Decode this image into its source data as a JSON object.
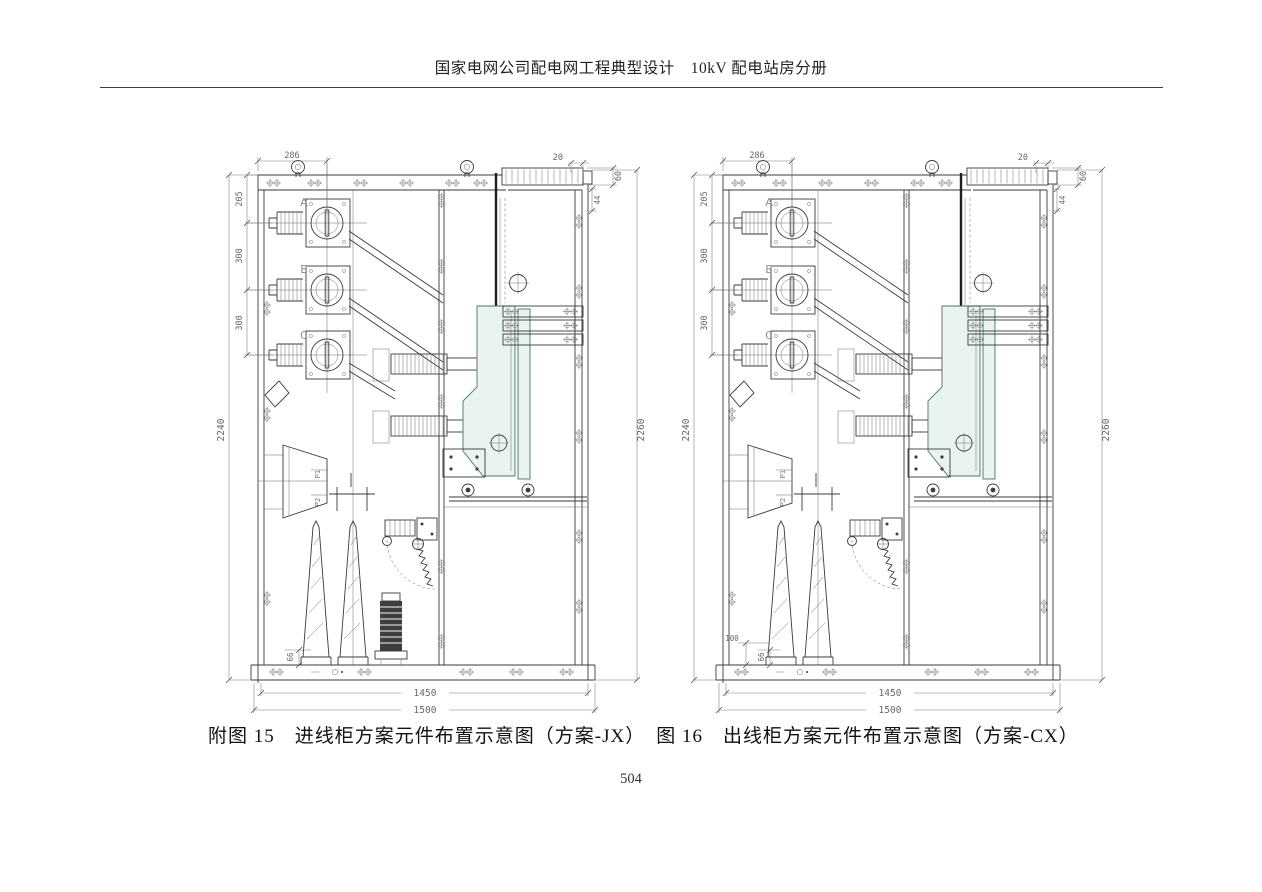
{
  "page": {
    "header_title": "国家电网公司配电网工程典型设计　10kV 配电站房分册",
    "page_number": "504"
  },
  "figures": [
    {
      "id": "JX",
      "caption": "附图 15　进线柜方案元件布置示意图（方案-JX）",
      "phases": {
        "a": "A",
        "b": "B",
        "c": "C"
      },
      "ct_terminals": {
        "p1": "P1",
        "p2": "P2"
      },
      "dims": {
        "top_width": "286",
        "louver_pitch": "20",
        "louver_height": "60",
        "louver_offset": "44",
        "phase_a_offset": "205",
        "phase_ab_gap": "300",
        "phase_bc_gap": "300",
        "height_left": "2240",
        "height_right": "2260",
        "base_height": "66",
        "inner_width": "1450",
        "overall_width": "1500"
      }
    },
    {
      "id": "CX",
      "caption": "图 16　出线柜方案元件布置示意图（方案-CX）",
      "phases": {
        "a": "A",
        "b": "B",
        "c": "C"
      },
      "ct_terminals": {
        "p1": "P1",
        "p2": "P2"
      },
      "dims": {
        "top_width": "286",
        "louver_pitch": "20",
        "louver_height": "60",
        "louver_offset": "44",
        "phase_a_offset": "205",
        "phase_ab_gap": "300",
        "phase_bc_gap": "300",
        "height_left": "2240",
        "height_right": "2260",
        "base_height": "66",
        "arrester_clearance": "100",
        "inner_width": "1450",
        "overall_width": "1500"
      }
    }
  ],
  "colors": {
    "line": "#3a3a3a",
    "dim_text": "#666666",
    "breaker_fill": "#e9f4f1",
    "breaker_stroke": "#45756e"
  }
}
